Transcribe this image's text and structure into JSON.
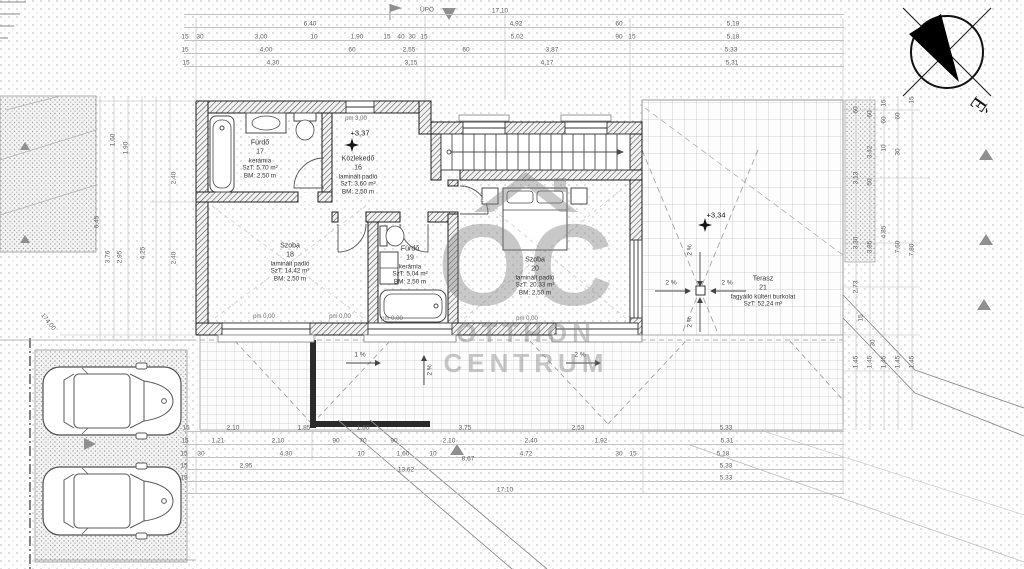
{
  "title": "emeleti alaprajz",
  "compass": {
    "north_label": "É"
  },
  "watermark": {
    "monogram": "OC",
    "name_line1": "OTTHON",
    "name_line2": "CENTRUM"
  },
  "palette": {
    "ink": "#3a3a3a",
    "wall": "#1c1c1c",
    "dim": "#5f5f5f",
    "marker_gray": "#8f8f8f",
    "watermark_gray": "#7e7e7e"
  },
  "rooms": [
    {
      "name": "Fürdő",
      "number": "17",
      "floor": "kerámia",
      "area": "SzT: 5,70 m²",
      "height": "BM: 2,50 m",
      "cx": 260,
      "cy": 160
    },
    {
      "name": "Közlekedő",
      "number": "16",
      "floor": "laminált padló",
      "area": "SzT: 3,60 m²",
      "height": "BM: 2,50 m",
      "cx": 358,
      "cy": 176
    },
    {
      "name": "Szoba",
      "number": "18",
      "floor": "laminált padló",
      "area": "SzT: 14,42 m²",
      "height": "BM: 2,50 m",
      "cx": 290,
      "cy": 263
    },
    {
      "name": "Fürdő",
      "number": "19",
      "floor": "kerámia",
      "area": "SzT: 5,04 m²",
      "height": "BM: 2,50 m",
      "cx": 410,
      "cy": 266
    },
    {
      "name": "Szoba",
      "number": "20",
      "floor": "laminált padló",
      "area": "SzT: 20,33 m²",
      "height": "BM: 2,50 m",
      "cx": 535,
      "cy": 277
    },
    {
      "name": "Terasz",
      "number": "21",
      "floor": "fagyálló kültéri burkolat",
      "area": "SzT: 52,24 m²",
      "height": "",
      "cx": 763,
      "cy": 292
    }
  ],
  "levels": [
    {
      "text": "+3,37",
      "x": 360,
      "y": 133
    },
    {
      "text": "+3,34",
      "x": 716,
      "y": 215
    }
  ],
  "parapets": [
    {
      "text": "pm 3,00",
      "x": 356,
      "y": 119
    },
    {
      "text": "pm 0,00",
      "x": 264,
      "y": 317
    },
    {
      "text": "pm 0,00",
      "x": 340,
      "y": 317
    },
    {
      "text": "pm 0,00",
      "x": 392,
      "y": 319
    },
    {
      "text": "pm 0,00",
      "x": 527,
      "y": 319
    }
  ],
  "slopes": [
    {
      "text": "2 %",
      "x": 671,
      "y": 283,
      "rot": 0
    },
    {
      "text": "2 %",
      "x": 727,
      "y": 283,
      "rot": 0
    },
    {
      "text": "2 %",
      "x": 690,
      "y": 250,
      "rot": -90
    },
    {
      "text": "2 %",
      "x": 690,
      "y": 322,
      "rot": -90
    },
    {
      "text": "1 %",
      "x": 360,
      "y": 355,
      "rot": 0
    },
    {
      "text": "2 %",
      "x": 580,
      "y": 355,
      "rot": 0
    },
    {
      "text": "2 %",
      "x": 430,
      "y": 370,
      "rot": -90
    }
  ],
  "dim_rows": {
    "top": [
      {
        "y": 11,
        "items": [
          {
            "t": "17,10",
            "x": 500
          }
        ]
      },
      {
        "y": 24,
        "items": [
          {
            "t": "6,40",
            "x": 310
          },
          {
            "t": "4,92",
            "x": 516
          },
          {
            "t": "60",
            "x": 619
          },
          {
            "t": "5,19",
            "x": 733
          }
        ]
      },
      {
        "y": 37,
        "items": [
          {
            "t": "15",
            "x": 185
          },
          {
            "t": "30",
            "x": 200
          },
          {
            "t": "3,00",
            "x": 261
          },
          {
            "t": "10",
            "x": 314
          },
          {
            "t": "1,90",
            "x": 357
          },
          {
            "t": "15",
            "x": 387
          },
          {
            "t": "40",
            "x": 401
          },
          {
            "t": "30",
            "x": 412
          },
          {
            "t": "15",
            "x": 424
          },
          {
            "t": "5,02",
            "x": 517
          },
          {
            "t": "90",
            "x": 619
          },
          {
            "t": "15",
            "x": 632
          },
          {
            "t": "5,18",
            "x": 733
          }
        ]
      },
      {
        "y": 50,
        "items": [
          {
            "t": "15",
            "x": 185
          },
          {
            "t": "4,00",
            "x": 266
          },
          {
            "t": "60",
            "x": 352
          },
          {
            "t": "2,55",
            "x": 409
          },
          {
            "t": "60",
            "x": 466
          },
          {
            "t": "3,87",
            "x": 552
          },
          {
            "t": "5,33",
            "x": 731
          }
        ]
      },
      {
        "y": 63,
        "items": [
          {
            "t": "15",
            "x": 186
          },
          {
            "t": "4,30",
            "x": 273
          },
          {
            "t": "3,15",
            "x": 411
          },
          {
            "t": "4,17",
            "x": 547
          },
          {
            "t": "5,31",
            "x": 732
          }
        ]
      }
    ],
    "bottom": [
      {
        "y": 428,
        "items": [
          {
            "t": "15",
            "x": 186
          },
          {
            "t": "2,10",
            "x": 233
          },
          {
            "t": "1,85",
            "x": 304
          },
          {
            "t": "1,60",
            "x": 363
          },
          {
            "t": "3,75",
            "x": 465
          },
          {
            "t": "2,53",
            "x": 578
          },
          {
            "t": "5,33",
            "x": 726
          }
        ]
      },
      {
        "y": 441,
        "items": [
          {
            "t": "15",
            "x": 185
          },
          {
            "t": "1,21",
            "x": 218
          },
          {
            "t": "2,10",
            "x": 278
          },
          {
            "t": "90",
            "x": 336
          },
          {
            "t": "70",
            "x": 363
          },
          {
            "t": "90",
            "x": 394
          },
          {
            "t": "2,10",
            "x": 449
          },
          {
            "t": "2,40",
            "x": 531
          },
          {
            "t": "1,92",
            "x": 601
          },
          {
            "t": "5,31",
            "x": 727
          }
        ]
      },
      {
        "y": 454,
        "items": [
          {
            "t": "15",
            "x": 184
          },
          {
            "t": "30",
            "x": 201
          },
          {
            "t": "4,30",
            "x": 286
          },
          {
            "t": "10",
            "x": 361
          },
          {
            "t": "1,60",
            "x": 403
          },
          {
            "t": "10",
            "x": 433
          },
          {
            "t": "4,72",
            "x": 526
          },
          {
            "t": "30",
            "x": 619
          },
          {
            "t": "15",
            "x": 633
          },
          {
            "t": "5,18",
            "x": 723
          }
        ]
      },
      {
        "y": 466,
        "items": [
          {
            "t": "15",
            "x": 184
          },
          {
            "t": "2,95",
            "x": 246
          },
          {
            "t": "5,33",
            "x": 726
          }
        ]
      },
      {
        "y": 478,
        "items": [
          {
            "t": "15",
            "x": 184
          },
          {
            "t": "5,33",
            "x": 726
          }
        ]
      },
      {
        "y": 490,
        "items": [
          {
            "t": "17,10",
            "x": 505
          }
        ]
      }
    ]
  },
  "dim_cols": {
    "left": [
      {
        "t": "1,60",
        "x": 113,
        "y": 140
      },
      {
        "t": "1,90",
        "x": 126,
        "y": 148
      },
      {
        "t": "6,45",
        "x": 97,
        "y": 222
      },
      {
        "t": "3,76",
        "x": 108,
        "y": 257
      },
      {
        "t": "2,95",
        "x": 120,
        "y": 257
      },
      {
        "t": "4,25",
        "x": 143,
        "y": 253
      },
      {
        "t": "2,40",
        "x": 174,
        "y": 178
      },
      {
        "t": "2,40",
        "x": 174,
        "y": 258
      }
    ],
    "right": [
      {
        "t": "60",
        "x": 856,
        "y": 110
      },
      {
        "t": "3,13",
        "x": 856,
        "y": 178
      },
      {
        "t": "3,30",
        "x": 856,
        "y": 243
      },
      {
        "t": "60",
        "x": 870,
        "y": 114
      },
      {
        "t": "3,42",
        "x": 870,
        "y": 152
      },
      {
        "t": "50",
        "x": 870,
        "y": 182
      },
      {
        "t": "3,85",
        "x": 870,
        "y": 247
      },
      {
        "t": "15",
        "x": 884,
        "y": 103
      },
      {
        "t": "60",
        "x": 884,
        "y": 120
      },
      {
        "t": "10",
        "x": 884,
        "y": 148
      },
      {
        "t": "4,85",
        "x": 884,
        "y": 232
      },
      {
        "t": "60",
        "x": 898,
        "y": 116
      },
      {
        "t": "30",
        "x": 898,
        "y": 152
      },
      {
        "t": "7,60",
        "x": 898,
        "y": 247
      },
      {
        "t": "15",
        "x": 912,
        "y": 100
      },
      {
        "t": "7,80",
        "x": 912,
        "y": 250
      },
      {
        "t": "2,73",
        "x": 856,
        "y": 287
      },
      {
        "t": "15",
        "x": 861,
        "y": 318
      },
      {
        "t": "30",
        "x": 873,
        "y": 343
      },
      {
        "t": "1,45",
        "x": 856,
        "y": 362
      },
      {
        "t": "1,45",
        "x": 870,
        "y": 362
      },
      {
        "t": "1,45",
        "x": 884,
        "y": 362
      },
      {
        "t": "1,45",
        "x": 898,
        "y": 362
      },
      {
        "t": "1,45",
        "x": 912,
        "y": 362
      }
    ]
  },
  "misc": [
    {
      "t": "ÜPÖ",
      "x": 427,
      "y": 10,
      "rot": 0
    },
    {
      "t": "13,62",
      "x": 406,
      "y": 470,
      "rot": 0
    },
    {
      "t": "8,67",
      "x": 468,
      "y": 459,
      "rot": 0
    },
    {
      "t": "174,00",
      "x": 48,
      "y": 322,
      "rot": 52
    }
  ]
}
